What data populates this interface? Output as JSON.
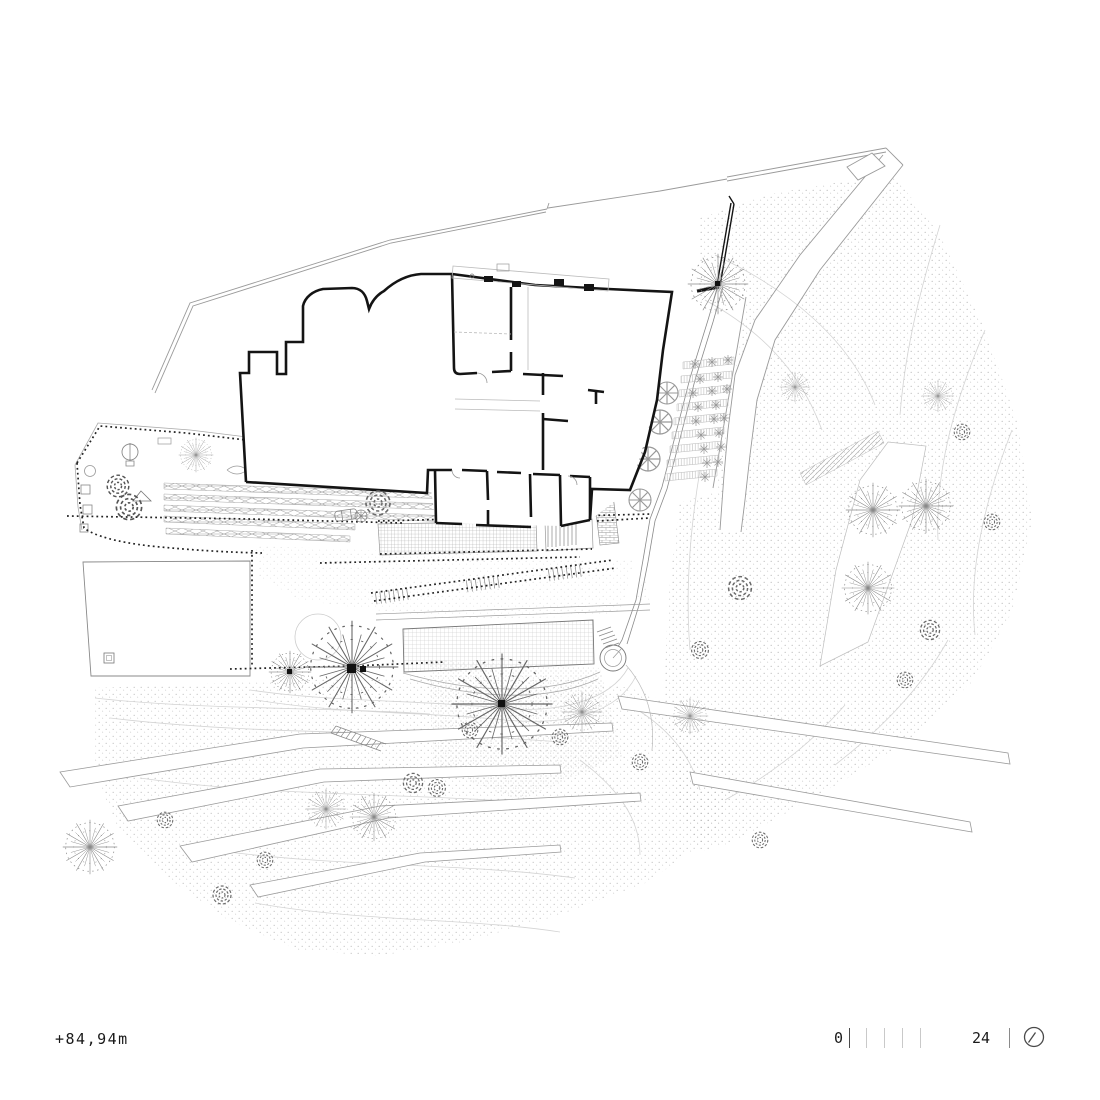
{
  "annotations": {
    "elevation_label": "+84,94m"
  },
  "scale_bar": {
    "zero_label": "0",
    "end_label": "24",
    "tick_count_left": 5,
    "tick_count_right": 1
  },
  "icons": {
    "north_indicator": "circle-slash-north-icon"
  },
  "colors": {
    "ink": "#141414",
    "mid_line": "#777777",
    "light_line": "#9a9a9a",
    "faint_line": "#cccccc",
    "background": "#ffffff"
  }
}
